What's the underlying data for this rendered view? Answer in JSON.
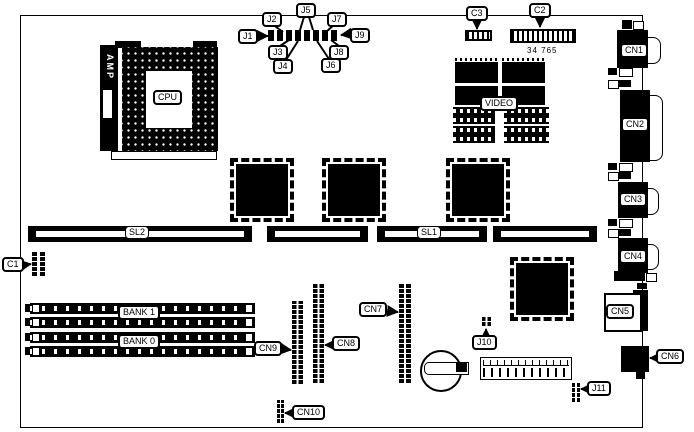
{
  "board": {
    "part_number": "34 765",
    "cpu": {
      "label": "CPU",
      "bracket": "AMP"
    },
    "video": {
      "label": "VIDEO"
    },
    "slots": {
      "sl1": "SL1",
      "sl2": "SL2"
    },
    "memory_banks": {
      "bank1": "BANK 1",
      "bank0": "BANK 0"
    },
    "jumpers": {
      "j1": "J1",
      "j2": "J2",
      "j3": "J3",
      "j4": "J4",
      "j5": "J5",
      "j6": "J6",
      "j7": "J7",
      "j8": "J8",
      "j9": "J9",
      "j10": "J10",
      "j11": "J11"
    },
    "components": {
      "c1": "C1",
      "c2": "C2",
      "c3": "C3"
    },
    "connectors": {
      "cn1": "CN1",
      "cn2": "CN2",
      "cn3": "CN3",
      "cn4": "CN4",
      "cn5": "CN5",
      "cn6": "CN6",
      "cn7": "CN7",
      "cn8": "CN8",
      "cn9": "CN9",
      "cn10": "CN10"
    }
  }
}
